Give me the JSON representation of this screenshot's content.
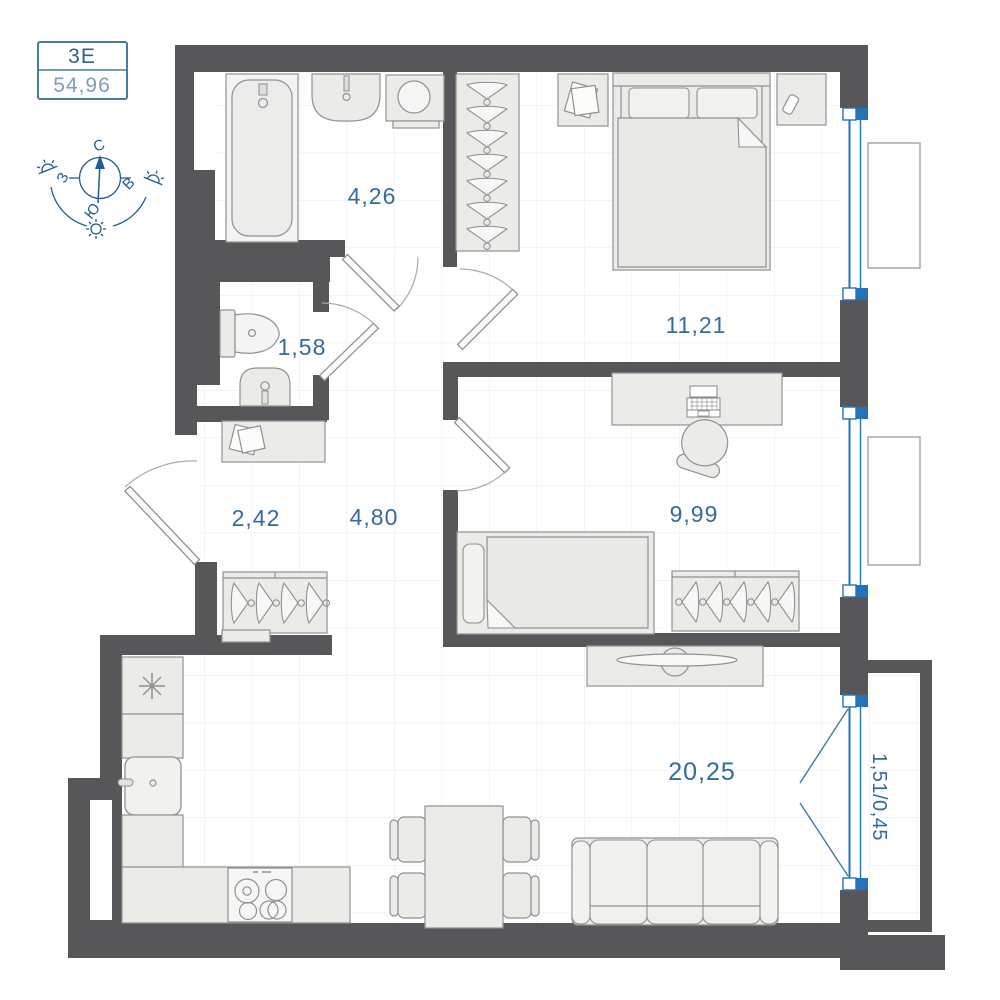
{
  "unit": {
    "type_label": "3Е",
    "area_label": "54,96"
  },
  "compass": {
    "north": "С",
    "east": "В",
    "south": "Ю",
    "west": "З"
  },
  "rooms": {
    "bathroom": {
      "area": "4,26"
    },
    "wc": {
      "area": "1,58"
    },
    "hallway": {
      "area": "2,42"
    },
    "corridor": {
      "area": "4,80"
    },
    "bedroom": {
      "area": "11,21"
    },
    "bedroom2": {
      "area": "9,99"
    },
    "living_kitchen": {
      "area": "20,25"
    },
    "balcony": {
      "area": "1,51/0,45"
    }
  },
  "icons": {
    "fridge": "snowflake-asterisk",
    "stove": "four-burner-cooktop",
    "hanger": "clothes-hanger",
    "sun": "sun-path-markers",
    "compass_needle": "north-arrow"
  },
  "colors": {
    "wall": "#575759",
    "window_blue": "#2273b8",
    "label_blue": "#336b9e",
    "compass_blue": "#1f5c99",
    "furniture_fill": "#ebebe7",
    "furniture_stroke": "#8f9192",
    "grid_line": "#e9edf0",
    "floor": "#ffffff"
  }
}
